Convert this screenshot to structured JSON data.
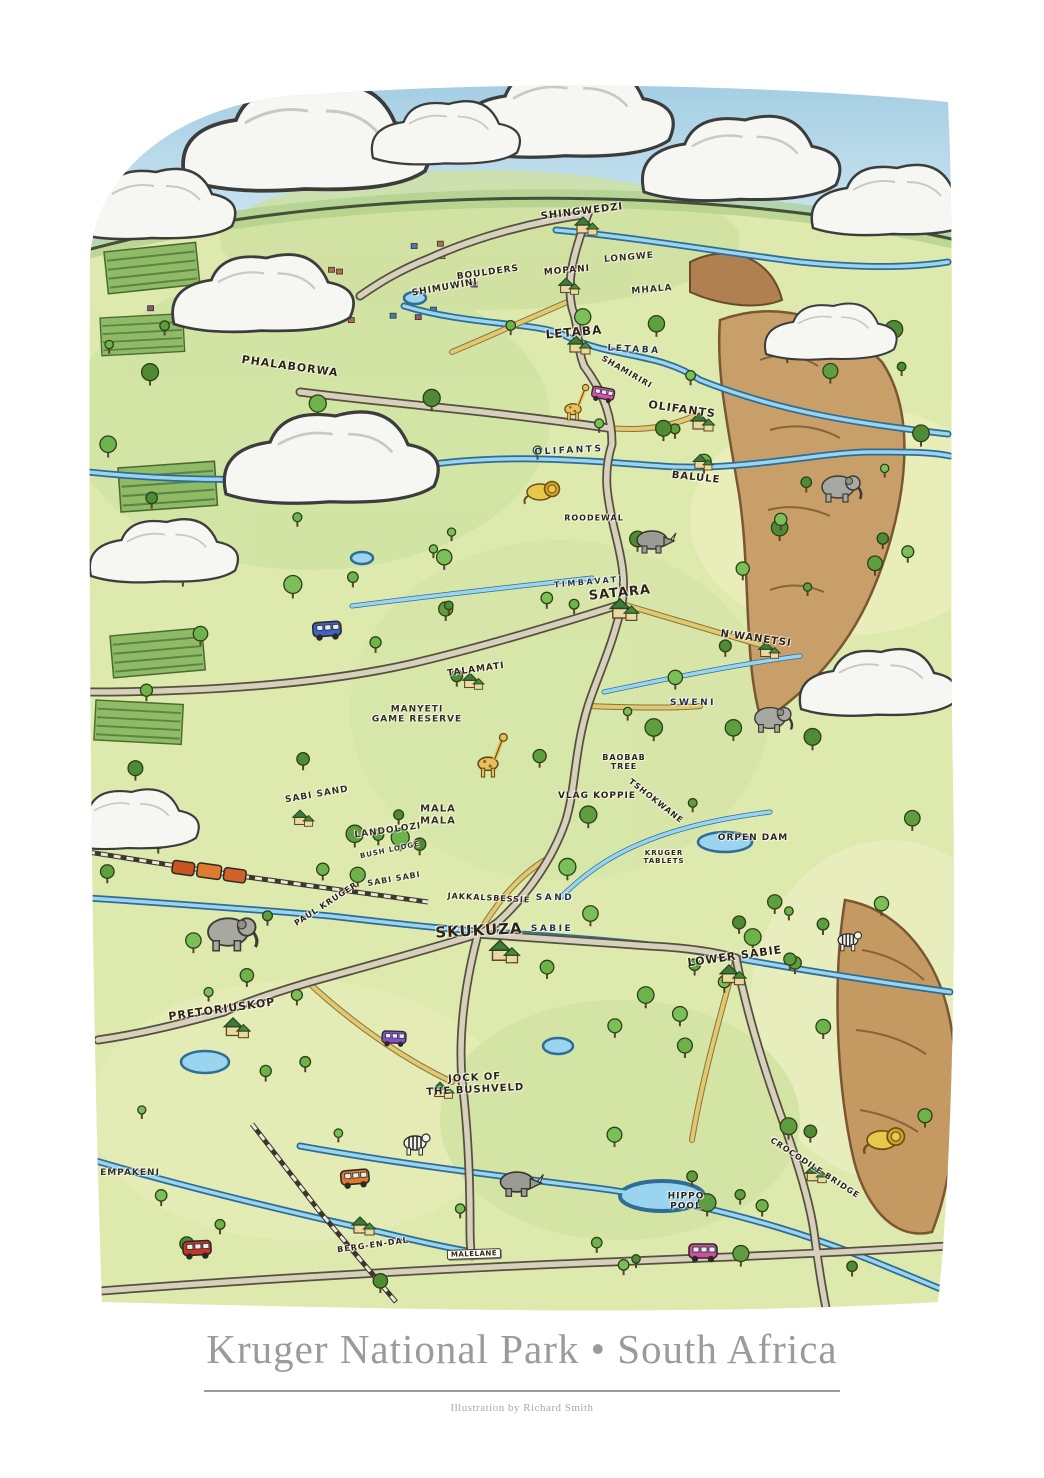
{
  "poster": {
    "title": "Kruger National Park • South Africa",
    "credit": "Illustration by Richard Smith"
  },
  "colors": {
    "sky": "#aed4e6",
    "land": "#dde9ad",
    "river_fill": "#9ad4ee",
    "river_ink": "#2f6d96",
    "road_fill": "#d6d0bd",
    "road_ink": "#56503f",
    "sandy_road": "#e0c96e",
    "cliff": "#c89f68",
    "tree_green": "#5f9e3f",
    "cloud_white": "#f6f6f2",
    "title_gray": "#9b9b9b",
    "label_ink": "#2e2414"
  },
  "map": {
    "labels": [
      {
        "text": "SHINGWEDZI",
        "x": 582,
        "y": 212,
        "size": 10,
        "rot": -7,
        "type": "camp"
      },
      {
        "text": "LONGWE",
        "x": 629,
        "y": 258,
        "size": 9,
        "rot": -5,
        "type": "area"
      },
      {
        "text": "MHALA",
        "x": 652,
        "y": 290,
        "size": 9,
        "rot": -5,
        "type": "area"
      },
      {
        "text": "BOULDERS",
        "x": 488,
        "y": 273,
        "size": 9,
        "rot": -8,
        "type": "poi"
      },
      {
        "text": "SHIMUWINI",
        "x": 445,
        "y": 288,
        "size": 9,
        "rot": -10,
        "type": "camp"
      },
      {
        "text": "MOPANI",
        "x": 567,
        "y": 271,
        "size": 9,
        "rot": -5,
        "type": "camp"
      },
      {
        "text": "LETABA",
        "x": 574,
        "y": 333,
        "size": 12,
        "rot": -5,
        "type": "camp"
      },
      {
        "text": "LETABA",
        "x": 634,
        "y": 350,
        "size": 9,
        "rot": 3,
        "type": "river"
      },
      {
        "text": "SHAMIRIRI",
        "x": 627,
        "y": 372,
        "size": 8,
        "rot": 30,
        "type": "poi"
      },
      {
        "text": "PHALABORWA",
        "x": 290,
        "y": 367,
        "size": 11,
        "rot": 8,
        "type": "town"
      },
      {
        "text": "OLIFANTS",
        "x": 682,
        "y": 410,
        "size": 11,
        "rot": 8,
        "type": "camp"
      },
      {
        "text": "OLIFANTS",
        "x": 569,
        "y": 451,
        "size": 9,
        "rot": -3,
        "type": "river"
      },
      {
        "text": "BALULE",
        "x": 696,
        "y": 478,
        "size": 10,
        "rot": 6,
        "type": "camp"
      },
      {
        "text": "ROODEWAL",
        "x": 594,
        "y": 518,
        "size": 8,
        "rot": 0,
        "type": "camp"
      },
      {
        "text": "TIMBAVATI",
        "x": 589,
        "y": 582,
        "size": 8,
        "rot": -5,
        "type": "river"
      },
      {
        "text": "SATARA",
        "x": 620,
        "y": 594,
        "size": 13,
        "rot": -6,
        "type": "camp"
      },
      {
        "text": "N'WANETSI",
        "x": 756,
        "y": 639,
        "size": 10,
        "rot": 8,
        "type": "camp"
      },
      {
        "text": "SWENI",
        "x": 693,
        "y": 703,
        "size": 9,
        "rot": 0,
        "type": "river"
      },
      {
        "text": "TALAMATI",
        "x": 476,
        "y": 670,
        "size": 9,
        "rot": -8,
        "type": "camp"
      },
      {
        "text": "MANYETI\nGAME RESERVE",
        "x": 417,
        "y": 715,
        "size": 9,
        "rot": 0,
        "type": "area"
      },
      {
        "text": "BAOBAB\nTREE",
        "x": 624,
        "y": 762,
        "size": 8,
        "rot": 0,
        "type": "poi"
      },
      {
        "text": "VLAG KOPPIE",
        "x": 597,
        "y": 796,
        "size": 9,
        "rot": 0,
        "type": "poi"
      },
      {
        "text": "TSHOKWANE",
        "x": 656,
        "y": 801,
        "size": 8,
        "rot": 38,
        "type": "poi"
      },
      {
        "text": "ORPEN DAM",
        "x": 753,
        "y": 838,
        "size": 9,
        "rot": 0,
        "type": "poi"
      },
      {
        "text": "KRUGER\nTABLETS",
        "x": 664,
        "y": 857,
        "size": 7,
        "rot": 0,
        "type": "poi"
      },
      {
        "text": "SABI SAND",
        "x": 317,
        "y": 795,
        "size": 9,
        "rot": -10,
        "type": "area"
      },
      {
        "text": "MALA\nMALA",
        "x": 438,
        "y": 815,
        "size": 10,
        "rot": 0,
        "type": "area"
      },
      {
        "text": "LANDOLOZI",
        "x": 388,
        "y": 831,
        "size": 9,
        "rot": -8,
        "type": "area"
      },
      {
        "text": "BUSH LODGE",
        "x": 390,
        "y": 850,
        "size": 7,
        "rot": -12,
        "type": "area"
      },
      {
        "text": "SABI SABI",
        "x": 394,
        "y": 879,
        "size": 8,
        "rot": -10,
        "type": "area"
      },
      {
        "text": "JAKKALSBESSIE",
        "x": 489,
        "y": 898,
        "size": 8,
        "rot": 3,
        "type": "poi"
      },
      {
        "text": "SAND",
        "x": 555,
        "y": 898,
        "size": 9,
        "rot": 0,
        "type": "river"
      },
      {
        "text": "SKUKUZA",
        "x": 479,
        "y": 931,
        "size": 15,
        "rot": -3,
        "type": "camp"
      },
      {
        "text": "SABIE",
        "x": 552,
        "y": 929,
        "size": 9,
        "rot": 0,
        "type": "river"
      },
      {
        "text": "PAUL KRUGER",
        "x": 326,
        "y": 904,
        "size": 8,
        "rot": -33,
        "type": "gate"
      },
      {
        "text": "LOWER SABIE",
        "x": 735,
        "y": 957,
        "size": 11,
        "rot": -8,
        "type": "camp"
      },
      {
        "text": "PRETORIUSKOP",
        "x": 222,
        "y": 1010,
        "size": 11,
        "rot": -8,
        "type": "camp"
      },
      {
        "text": "JOCK OF\nTHE BUSHVELD",
        "x": 475,
        "y": 1084,
        "size": 10,
        "rot": -3,
        "type": "poi"
      },
      {
        "text": "EMPAKENI",
        "x": 130,
        "y": 1173,
        "size": 9,
        "rot": 0,
        "type": "area"
      },
      {
        "text": "BERG-EN-DAL",
        "x": 373,
        "y": 1245,
        "size": 8,
        "rot": -8,
        "type": "camp"
      },
      {
        "text": "MALELANE",
        "x": 474,
        "y": 1254,
        "size": 7,
        "rot": -2,
        "type": "sign"
      },
      {
        "text": "CROCODILE BRIDGE",
        "x": 815,
        "y": 1168,
        "size": 8,
        "rot": 33,
        "type": "camp"
      },
      {
        "text": "HIPPO\nPOOL",
        "x": 686,
        "y": 1202,
        "size": 9,
        "rot": 0,
        "type": "poi"
      }
    ]
  }
}
